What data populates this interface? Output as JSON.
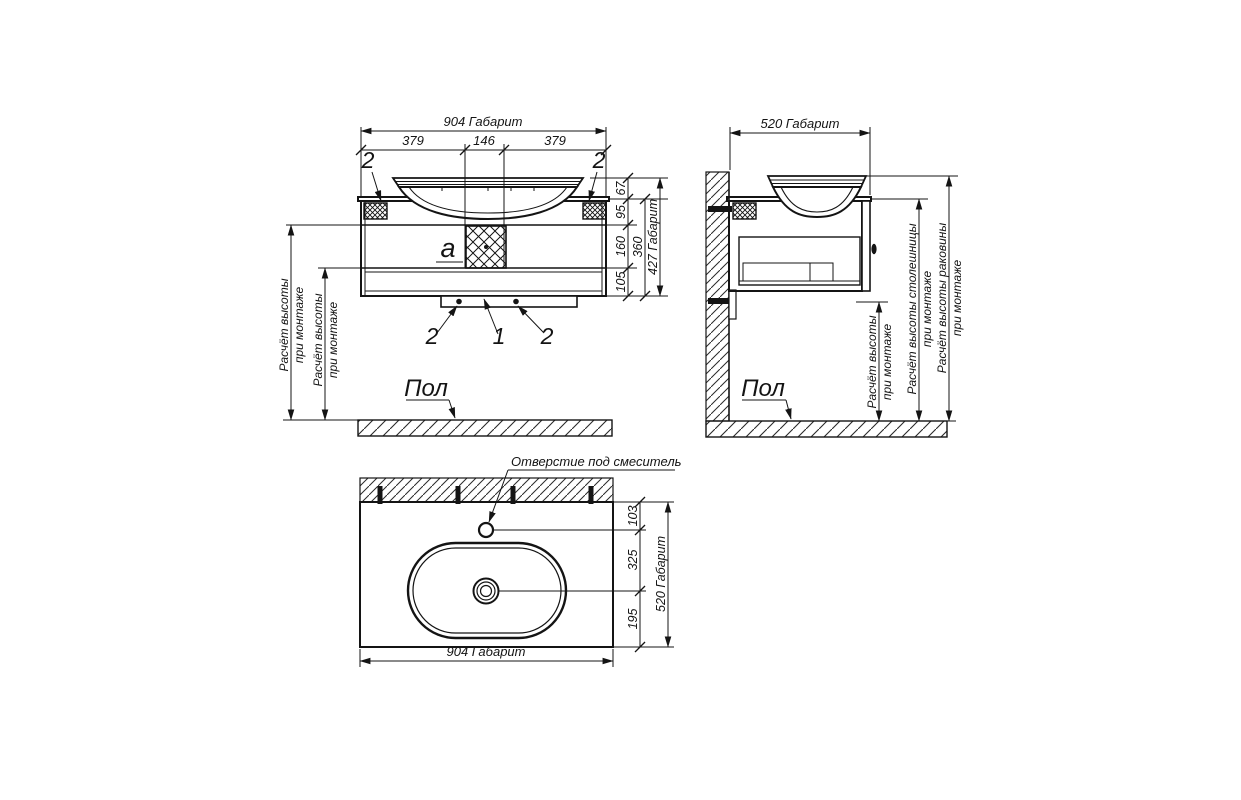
{
  "drawing": {
    "front": {
      "dim_overall_w": "904 Габарит",
      "dim_379a": "379",
      "dim_146": "146",
      "dim_379b": "379",
      "dim_67": "67",
      "dim_95": "95",
      "dim_160": "160",
      "dim_105": "105",
      "dim_360": "360",
      "dim_overall_h": "427 Габарит",
      "callout_bracket_left": "2",
      "callout_bracket_right": "2",
      "callout_screw_left": "2",
      "callout_rail": "1",
      "callout_screw_right": "2",
      "callout_panel": "a",
      "note_line1": "Расчёт высоты",
      "note_line2": "при монтаже",
      "floor": "Пол"
    },
    "side": {
      "dim_overall_d": "520 Габарит",
      "note_height_1": "Расчёт высоты",
      "note_height_2": "при монтаже",
      "note_top_1": "Расчёт высоты столешницы",
      "note_top_2": "при монтаже",
      "note_basin_1": "Расчёт высоты раковины",
      "note_basin_2": "при монтаже",
      "floor": "Пол"
    },
    "plan": {
      "faucet_label": "Отверстие под смеситель",
      "dim_103": "103",
      "dim_325": "325",
      "dim_195": "195",
      "dim_overall_d": "520 Габарит",
      "dim_overall_w": "904 Габарит"
    }
  }
}
